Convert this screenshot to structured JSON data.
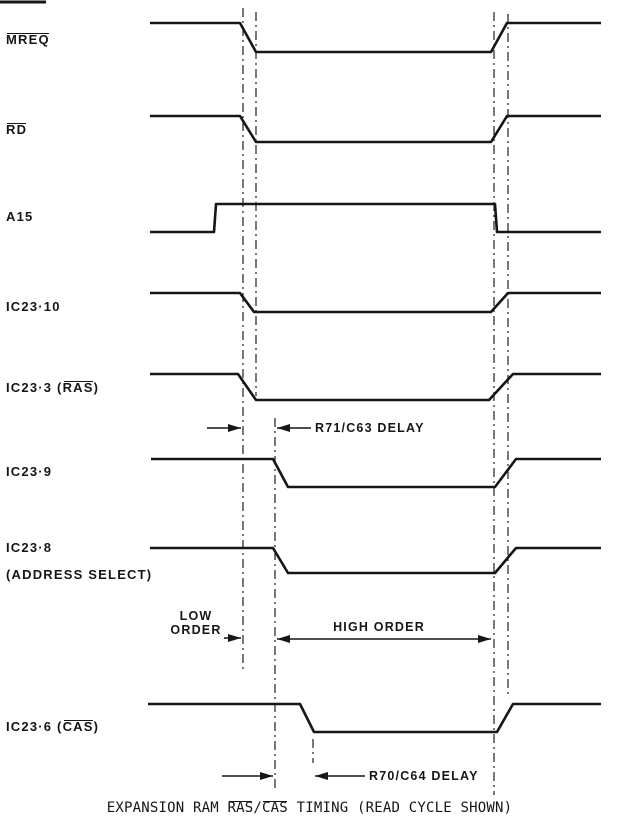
{
  "diagram": {
    "colors": {
      "ink": "#161616",
      "background": "#ffffff"
    },
    "signals": [
      {
        "name": "mreq",
        "label": {
          "pre": "",
          "over": "MREQ",
          "post": ""
        },
        "points": [
          [
            150,
            23
          ],
          [
            240,
            23
          ],
          [
            256,
            52
          ],
          [
            491,
            52
          ],
          [
            507,
            23
          ],
          [
            601,
            23
          ]
        ]
      },
      {
        "name": "rd",
        "label": {
          "pre": "",
          "over": "RD",
          "post": ""
        },
        "points": [
          [
            150,
            116
          ],
          [
            240,
            116
          ],
          [
            256,
            142
          ],
          [
            491,
            142
          ],
          [
            507,
            116
          ],
          [
            601,
            116
          ]
        ]
      },
      {
        "name": "a15",
        "label": {
          "pre": "A15",
          "over": "",
          "post": ""
        },
        "points": [
          [
            150,
            232
          ],
          [
            214,
            232
          ],
          [
            216,
            204
          ],
          [
            495,
            204
          ],
          [
            497,
            232
          ],
          [
            601,
            232
          ]
        ]
      },
      {
        "name": "ic23-10",
        "label": {
          "pre": "IC23·10",
          "over": "",
          "post": ""
        },
        "points": [
          [
            150,
            293
          ],
          [
            240,
            293
          ],
          [
            254,
            312
          ],
          [
            491,
            312
          ],
          [
            508,
            293
          ],
          [
            601,
            293
          ]
        ]
      },
      {
        "name": "ic23-3-ras",
        "label": {
          "pre": "IC23·3 (",
          "over": "RAS",
          "post": ")"
        },
        "points": [
          [
            150,
            374
          ],
          [
            238,
            374
          ],
          [
            256,
            400
          ],
          [
            489,
            400
          ],
          [
            513,
            374
          ],
          [
            601,
            374
          ]
        ]
      },
      {
        "name": "ic23-9",
        "label": {
          "pre": "IC23·9",
          "over": "",
          "post": ""
        },
        "points": [
          [
            151,
            459
          ],
          [
            273,
            459
          ],
          [
            288,
            487
          ],
          [
            495,
            487
          ],
          [
            516,
            459
          ],
          [
            601,
            459
          ]
        ]
      },
      {
        "name": "ic23-8-address-select",
        "label": {
          "pre": "IC23·8",
          "over": "",
          "post": "",
          "line2": "(ADDRESS SELECT)"
        },
        "points": [
          [
            150,
            548
          ],
          [
            273,
            548
          ],
          [
            288,
            573
          ],
          [
            495,
            573
          ],
          [
            516,
            548
          ],
          [
            601,
            548
          ]
        ]
      },
      {
        "name": "ic23-6-cas",
        "label": {
          "pre": "IC23·6 (",
          "over": "CAS",
          "post": ")"
        },
        "points": [
          [
            148,
            704
          ],
          [
            300,
            704
          ],
          [
            314,
            732
          ],
          [
            497,
            732
          ],
          [
            513,
            704
          ],
          [
            601,
            704
          ]
        ]
      }
    ],
    "ref_lines": [
      {
        "x": 243,
        "y1": 8,
        "y2": 670
      },
      {
        "x": 256,
        "y1": 12,
        "y2": 396
      },
      {
        "x": 275,
        "y1": 418,
        "y2": 792
      },
      {
        "x": 313,
        "y1": 739,
        "y2": 763
      },
      {
        "x": 494,
        "y1": 12,
        "y2": 795
      },
      {
        "x": 508,
        "y1": 14,
        "y2": 697
      }
    ],
    "arrows": [
      {
        "x1": 207,
        "y1": 428,
        "x2": 241,
        "y2": 428,
        "heads": "end"
      },
      {
        "x1": 311,
        "y1": 428,
        "x2": 277,
        "y2": 428,
        "heads": "end"
      },
      {
        "x1": 224,
        "y1": 638,
        "x2": 241,
        "y2": 638,
        "heads": "end"
      },
      {
        "x1": 277,
        "y1": 639,
        "x2": 491,
        "y2": 639,
        "heads": "both"
      },
      {
        "x1": 222,
        "y1": 776,
        "x2": 273,
        "y2": 776,
        "heads": "end"
      },
      {
        "x1": 365,
        "y1": 776,
        "x2": 315,
        "y2": 776,
        "heads": "end"
      }
    ],
    "marks": [
      {
        "x1": 0,
        "y1": 2,
        "x2": 46,
        "y2": 2
      }
    ],
    "annotations": {
      "r71_c63": {
        "text": "R71/C63 DELAY"
      },
      "low_order": {
        "line1": "LOW",
        "line2": "ORDER"
      },
      "high_order": {
        "text": "HIGH ORDER"
      },
      "r70_c64": {
        "text": "R70/C64 DELAY"
      }
    },
    "caption": {
      "pre": "EXPANSION RAM ",
      "ras": "RAS",
      "slash": "/",
      "cas": "CAS",
      "post": " TIMING (READ CYCLE SHOWN)"
    }
  }
}
